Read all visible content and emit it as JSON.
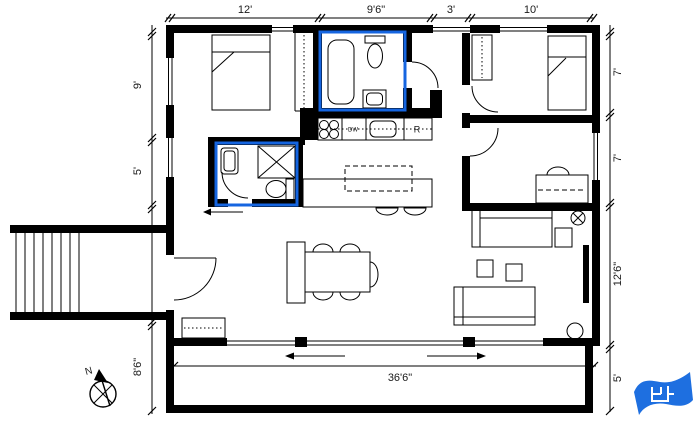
{
  "canvas": {
    "width": 697,
    "height": 427
  },
  "colors": {
    "wall": "#000000",
    "bathroom_highlight": "#1565e0",
    "logo_blue": "#1e6fe0",
    "background": "#ffffff"
  },
  "dimensions": {
    "top": [
      "12'",
      "9'6\"",
      "3'",
      "10'"
    ],
    "right": [
      "7'",
      "7'",
      "12'6\"",
      "5'"
    ],
    "left": [
      "9'",
      "5'",
      "8'6\""
    ],
    "bottom": "36'6\""
  },
  "labels": {
    "dishwasher": "DW",
    "refrigerator": "R",
    "north": "N"
  },
  "fixtures": [
    "double-bed",
    "single-bed",
    "wardrobe-closet",
    "bathtub",
    "toilet",
    "bathroom-sink",
    "shower",
    "kitchen-counter",
    "cooktop",
    "kitchen-sink",
    "dishwasher",
    "refrigerator",
    "kitchen-island",
    "bar-stool",
    "dining-table",
    "dining-chair",
    "bench",
    "sofa",
    "side-table",
    "end-table",
    "desk",
    "desk-chair",
    "ceiling-light",
    "floor-lamp",
    "tv",
    "dresser",
    "entry-stairs",
    "deck",
    "sliding-glass-door",
    "hinged-door",
    "window",
    "compass-rose",
    "blueprint-logo"
  ]
}
